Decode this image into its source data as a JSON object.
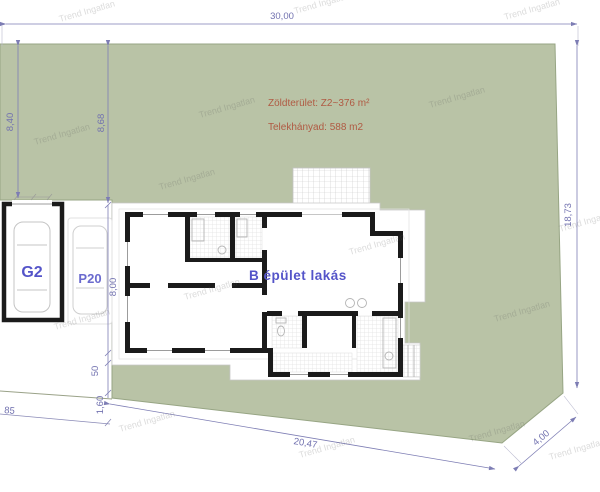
{
  "plan": {
    "lot": {
      "note_green_area": "Zöldterület: Z2~376 m²",
      "note_plot_ratio": "Telekhányad: 588 m2"
    },
    "labels": {
      "building": "B épület lakás",
      "garage": "G2",
      "parking": "P20"
    },
    "dims": {
      "top": "30,00",
      "left_a": "8,40",
      "left_b": "8,68",
      "right": "18,73",
      "house": "8,00",
      "eave": "50",
      "strip": "1,60",
      "corner": "85",
      "bottom": "20,47",
      "cut": "4,00"
    },
    "watermark": "Trend Ingatlan",
    "colors": {
      "lawn": "#b9c3a6",
      "lawn_edge": "#97a584",
      "dimension": "#7d7db4",
      "label_blue": "#5454c9",
      "note_red": "#b05a43",
      "wall": "#1b1b1b"
    }
  }
}
